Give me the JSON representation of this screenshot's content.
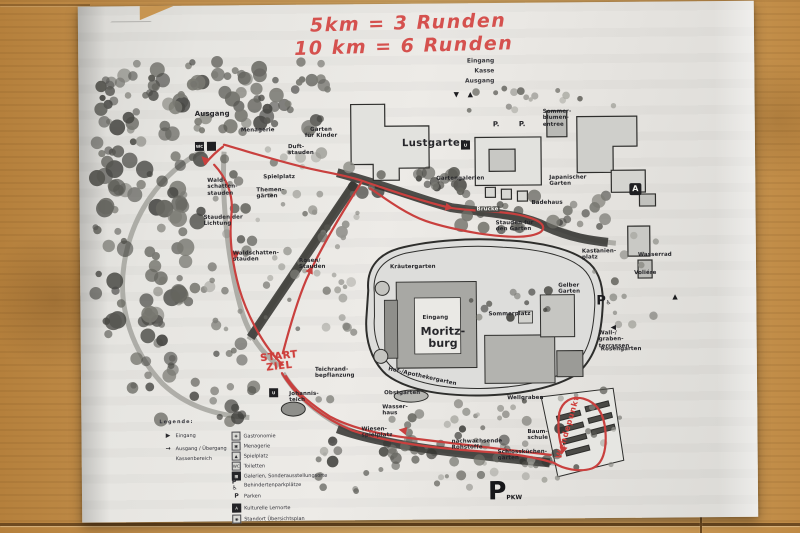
{
  "colors": {
    "route_red": "#c9403e",
    "handwriting_red": "#d5514e",
    "paper": "#e6e5e1"
  },
  "handwriting": {
    "line1": "5km = 3 Runden",
    "line2": "10 km = 6 Runden",
    "start": "START\nZIEL",
    "turnpoint": "Wendepunkt"
  },
  "map": {
    "entrance_block": "Eingang\nKasse\nAusgang",
    "marker_down": "▼",
    "marker_up": "▲",
    "marker_left": "◀",
    "icon_a": "A",
    "icon_wc": "WC",
    "icon_u": "U",
    "parking_accessible": {
      "p": "P",
      "sub": "♿"
    },
    "parking_big": {
      "p": "P",
      "sub": "PKW"
    },
    "labels": [
      {
        "text": "Ausgang"
      },
      {
        "text": "Menagerie"
      },
      {
        "text": "Garten\nfür Kinder"
      },
      {
        "text": "Lustgarten"
      },
      {
        "text": "Sommer-\nblumen-\nentree"
      },
      {
        "text": "P."
      },
      {
        "text": "P."
      },
      {
        "text": "Gartengalerien"
      },
      {
        "text": "Japanischer\nGarten"
      },
      {
        "text": "Badehaus"
      },
      {
        "text": "Brücke"
      },
      {
        "text": "Stauden für\nden Garten"
      },
      {
        "text": "Duft-\nstauden"
      },
      {
        "text": "Spielplatz"
      },
      {
        "text": "Themen-\ngärten"
      },
      {
        "text": "Wald-\nschatten-\nstauden"
      },
      {
        "text": "Stauden der\nLichtung"
      },
      {
        "text": "Waldschatten-\nstauden"
      },
      {
        "text": "Rosen/\nStauden"
      },
      {
        "text": "Kräutergarten"
      },
      {
        "text": "Eingang"
      },
      {
        "text": "Moritz-\nburg"
      },
      {
        "text": "Sommerplatz"
      },
      {
        "text": "Kastanien-\nplatz"
      },
      {
        "text": "Gelber\nGarten"
      },
      {
        "text": "Wall-/\ngraben-\nterrassen"
      },
      {
        "text": "Rosengarten"
      },
      {
        "text": "Wasserrad"
      },
      {
        "text": "Voliére"
      },
      {
        "text": "Hof-/Apothekergarten"
      },
      {
        "text": "Teichrand-\nbepflanzung"
      },
      {
        "text": "Johannis-\nteich"
      },
      {
        "text": "Obstgarten"
      },
      {
        "text": "Wasser-\nhaus"
      },
      {
        "text": "Wiesen-\nspielplatz"
      },
      {
        "text": "nachwachsende\nRohstoffe"
      },
      {
        "text": "Schlossküchen-\ngarten"
      },
      {
        "text": "Wellgraben"
      },
      {
        "text": "Baum-\nschule"
      }
    ]
  },
  "legend": {
    "title": "Legende:",
    "left": [
      {
        "icon": "▶",
        "label": "Eingang"
      },
      {
        "icon": "→",
        "label": "Ausgang / Übergang"
      },
      {
        "icon": "",
        "label": "Kassenbereich"
      }
    ],
    "right": [
      {
        "label": "Gastronomie"
      },
      {
        "label": "Menagerie"
      },
      {
        "label": "Spielplatz"
      },
      {
        "label": "Toiletten"
      },
      {
        "label": "Galerien, Sonderausstellungsorte"
      },
      {
        "label": "Behindertenparkplätze"
      },
      {
        "label": "Parken"
      },
      {
        "label": "Kulturelle Lernorte"
      },
      {
        "label": "Standort Übersichtsplan"
      }
    ]
  }
}
